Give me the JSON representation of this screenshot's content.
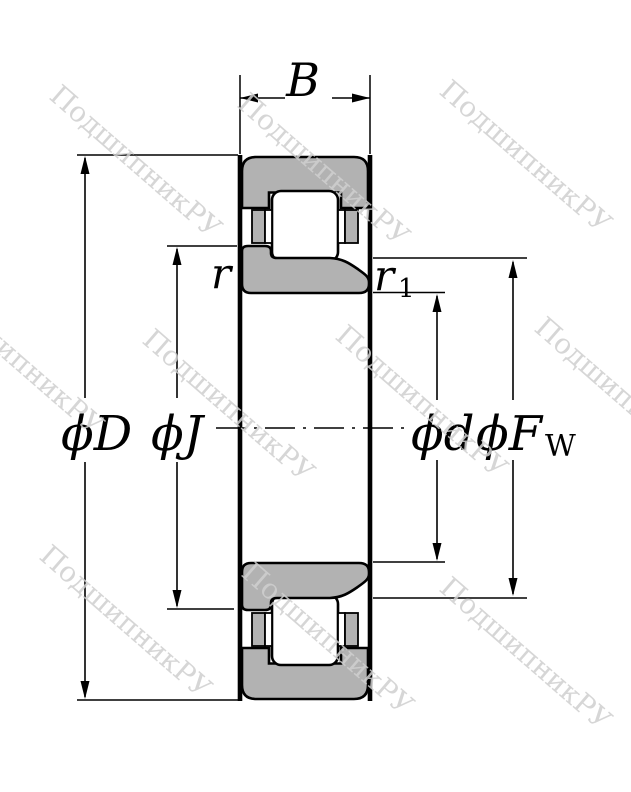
{
  "drawing_labels": {
    "width": "B",
    "outer_diameter": "ϕD",
    "rib_diameter": "ϕJ",
    "bore_diameter": "ϕd",
    "raceway_diameter_main": "ϕF",
    "raceway_diameter_sub": "W",
    "chamfer_r": "r",
    "chamfer_r1_main": "r",
    "chamfer_r1_sub": "1"
  },
  "watermark": {
    "text": "ПодшипникРУ"
  },
  "colors": {
    "ring_fill": "#b2b2b2",
    "cage_fill": "#b2b2b2",
    "outline": "#000000",
    "watermark": "#cfcfcf",
    "background": "#ffffff"
  }
}
